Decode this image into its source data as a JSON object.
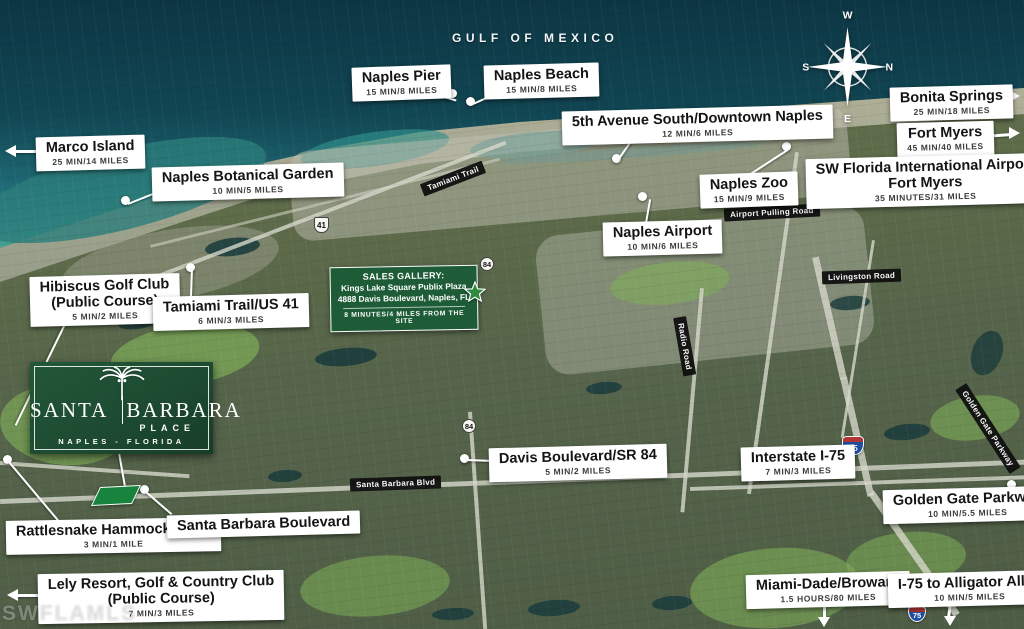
{
  "sea": {
    "label": "GULF OF MEXICO"
  },
  "compass": {
    "top": "W",
    "right": "N",
    "left": "S",
    "bottom": "E"
  },
  "watermark": "SWFLAMLS",
  "poi": {
    "naples_pier": {
      "title": "Naples Pier",
      "sub": "15 MIN/8 MILES"
    },
    "naples_beach": {
      "title": "Naples Beach",
      "sub": "15 MIN/8 MILES"
    },
    "marco_island": {
      "title": "Marco Island",
      "sub": "25 MIN/14 MILES"
    },
    "botanical_garden": {
      "title": "Naples Botanical Garden",
      "sub": "10 MIN/5 MILES"
    },
    "fifth_avenue": {
      "title": "5th Avenue South/Downtown Naples",
      "sub": "12 MIN/6 MILES"
    },
    "bonita_springs": {
      "title": "Bonita Springs",
      "sub": "25 MIN/18 MILES"
    },
    "fort_myers": {
      "title": "Fort Myers",
      "sub": "45 MIN/40 MILES"
    },
    "sw_intl_airport": {
      "title": "SW Florida International Airport",
      "title2": "Fort Myers",
      "sub": "35 MINUTES/31 MILES"
    },
    "naples_zoo": {
      "title": "Naples Zoo",
      "sub": "15 MIN/9 MILES"
    },
    "naples_airport": {
      "title": "Naples Airport",
      "sub": "10 MIN/6 MILES"
    },
    "hibiscus_golf": {
      "title": "Hibiscus Golf Club",
      "title2": "(Public Course)",
      "sub": "5 MIN/2 MILES"
    },
    "tamiami_trail": {
      "title": "Tamiami Trail/US 41",
      "sub": "6 MIN/3 MILES"
    },
    "davis_blvd": {
      "title": "Davis Boulevard/SR 84",
      "sub": "5 MIN/2 MILES"
    },
    "interstate_75": {
      "title": "Interstate I-75",
      "sub": "7 MIN/3 MILES"
    },
    "golden_gate_pkwy": {
      "title": "Golden Gate Parkway",
      "sub": "10 MIN/5.5 MILES"
    },
    "rattlesnake": {
      "title": "Rattlesnake Hammock Road",
      "sub": "3 MIN/1 MILE"
    },
    "santa_barbara_blvd": {
      "title": "Santa Barbara Boulevard"
    },
    "lely_resort": {
      "title": "Lely Resort, Golf & Country Club",
      "title2": "(Public Course)",
      "sub": "7 MIN/3 MILES"
    },
    "miami_dade": {
      "title": "Miami-Dade/Broward",
      "sub": "1.5 HOURS/80 MILES"
    },
    "alligator_alley": {
      "title": "I-75 to Alligator Alley",
      "sub": "10 MIN/5 MILES"
    }
  },
  "road_tags": {
    "tamiami_trail": "Tamiami Trail",
    "airport_pulling": "Airport Pulling Road",
    "livingston": "Livingston Road",
    "radio_road": "Radio Road",
    "golden_gate": "Golden Gate Parkway",
    "santa_barbara": "Santa Barbara Blvd"
  },
  "shields": {
    "us41": "41",
    "sr84": "84",
    "i75": "75"
  },
  "logo": {
    "left": "SANTA",
    "right": "BARBARA",
    "place": "PLACE",
    "city": "NAPLES - FLORIDA"
  },
  "sales_gallery": {
    "heading": "SALES GALLERY:",
    "line1": "Kings Lake Square Publix Plaza",
    "line2": "4888 Davis Boulevard, Naples, FL",
    "note": "8 MINUTES/4 MILES FROM THE SITE"
  },
  "colors": {
    "logo_green": "#1d4b31",
    "gallery_green": "#1e5c38",
    "site_green": "#17833c"
  }
}
